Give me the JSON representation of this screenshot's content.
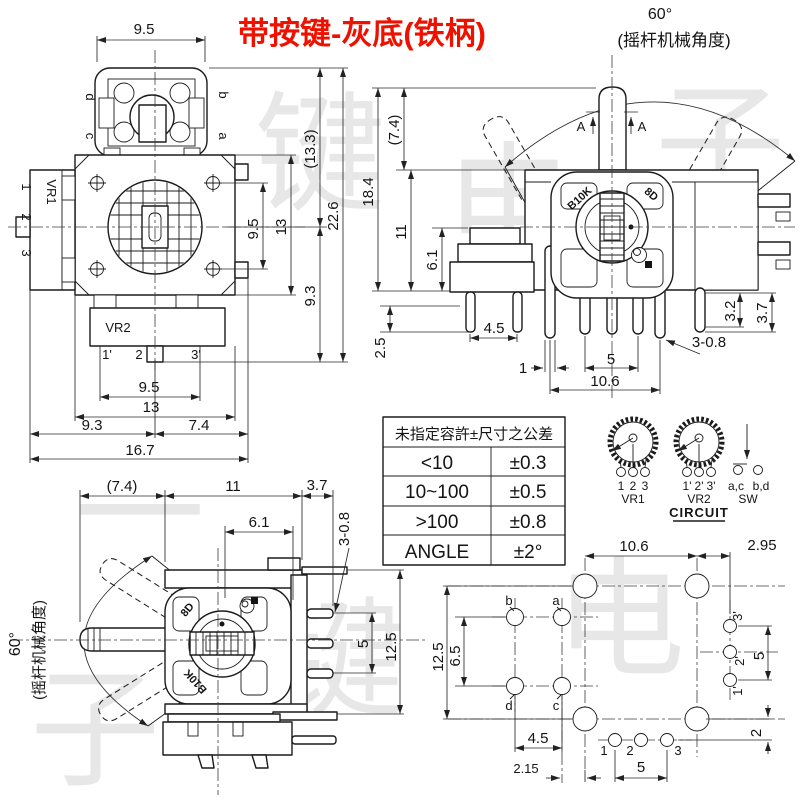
{
  "title": "带按键-灰底(铁柄)",
  "watermark": [
    "键",
    "电",
    "子",
    "一",
    "键",
    "电",
    "子"
  ],
  "tl": {
    "d95t": "9.5",
    "pd": "d",
    "pb": "b",
    "pc": "c",
    "pa": "a",
    "vr1": "VR1",
    "vr1_pins": [
      "1",
      "2",
      "3"
    ],
    "vr2": "VR2",
    "vr2_pins": [
      "1'",
      "2",
      "3'"
    ],
    "d95r": "9.5",
    "d13r": "13",
    "d133": "(13.3)",
    "d226": "22.6",
    "d93r": "9.3",
    "d95b": "9.5",
    "d13b": "13",
    "d93b": "9.3",
    "d74b": "7.4",
    "d167": "16.7"
  },
  "fv": {
    "angle": "60°",
    "note": "(摇杆机械角度)",
    "section": "A",
    "b10k": "B10K",
    "code": "8D",
    "d184": "18.4",
    "d74": "(7.4)",
    "d11": "11",
    "d61": "6.1",
    "d25": "2.5",
    "d45": "4.5",
    "d1": "1",
    "d5": "5",
    "d106": "10.6",
    "d308": "3-0.8",
    "d32": "3.2",
    "d37": "3.7"
  },
  "tbl": {
    "header": "未指定容許±尺寸之公差",
    "rows": [
      [
        "<10",
        "±0.3"
      ],
      [
        "10~100",
        "±0.5"
      ],
      [
        ">100",
        "±0.8"
      ],
      [
        "ANGLE",
        "±2°"
      ]
    ]
  },
  "cir": {
    "vr1": "VR1",
    "vr1_pins": [
      "1",
      "2",
      "3"
    ],
    "vr2": "VR2",
    "vr2_pins": [
      "1'",
      "2'",
      "3'"
    ],
    "sw": "SW",
    "t1": "a,c",
    "t2": "b,d",
    "caption": "CIRCUIT"
  },
  "sv": {
    "angle": "60°",
    "note": "(摇杆机械角度)",
    "b10k": "B10K",
    "code": "8D",
    "d74": "(7.4)",
    "d11": "11",
    "d61": "6.1",
    "d37": "3.7",
    "d308": "3-0.8",
    "d125": "12.5",
    "d5": "5"
  },
  "pcb": {
    "d106": "10.6",
    "d295": "2.95",
    "d125": "12.5",
    "d65": "6.5",
    "d45": "4.5",
    "d215": "2.15",
    "d5b": "5",
    "d5r": "5",
    "d2": "2",
    "hb": "b",
    "ha": "a",
    "hd": "d",
    "hc": "c",
    "p1": "1",
    "p2": "2",
    "p3": "3",
    "q1": "1'",
    "q2": "2'",
    "q3": "3'"
  }
}
